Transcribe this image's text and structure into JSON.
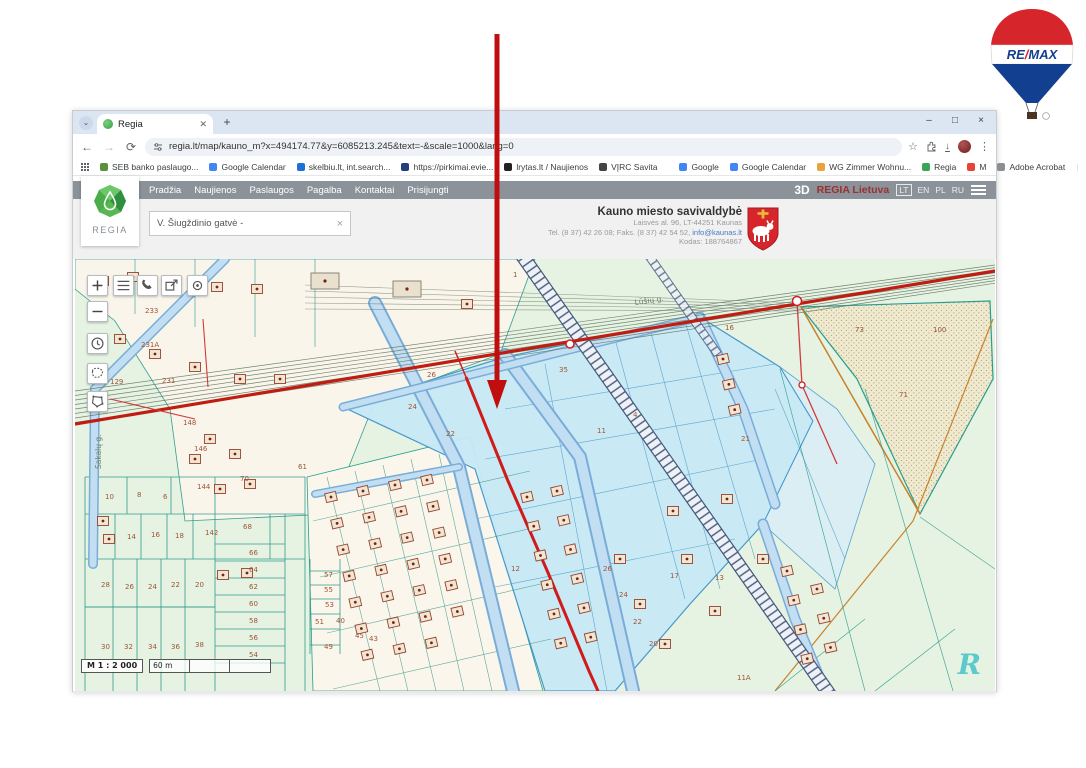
{
  "browser": {
    "tab_title": "Regia",
    "new_tab": "+",
    "window_controls": [
      "–",
      "□",
      "×"
    ],
    "url": "regia.lt/map/kauno_m?x=494174.77&y=6085213.245&text=-&scale=1000&lang=0",
    "bookmarks_left": [
      {
        "label": "SEB banko paslaugo...",
        "color": "#5a8f3c"
      },
      {
        "label": "Google Calendar",
        "color": "#4285f4"
      },
      {
        "label": "skelbiu.lt, int.search...",
        "color": "#1e6fd9"
      },
      {
        "label": "https://pirkimai.evie...",
        "color": "#24407c"
      },
      {
        "label": "lrytas.lt / Naujienos",
        "color": "#222222"
      },
      {
        "label": "VĮRC Savita",
        "color": "#444444"
      }
    ],
    "bookmarks_right": [
      {
        "label": "Google",
        "color": "#4285f4"
      },
      {
        "label": "Google Calendar",
        "color": "#4285f4"
      },
      {
        "label": "WG Zimmer Wohnu...",
        "color": "#e8a33d"
      },
      {
        "label": "Regia",
        "color": "#3aa655"
      },
      {
        "label": "M",
        "color": "#ea4335"
      },
      {
        "label": "Adobe Acrobat",
        "color": "#8a8f94"
      }
    ],
    "all_bookmarks": "Visos žymės"
  },
  "site": {
    "logo_text": "REGIA",
    "nav": [
      "Pradžia",
      "Naujienos",
      "Paslaugos",
      "Pagalba",
      "Kontaktai",
      "Prisijungti"
    ],
    "three_d": "3D",
    "brand": "REGIA Lietuva",
    "languages": [
      "LT",
      "EN",
      "PL",
      "RU"
    ],
    "search_value": "V. Šiugždinio gatvė -",
    "search_clear": "×",
    "municipality": {
      "name": "Kauno miesto savivaldybė",
      "address": "Laisvės al. 96, LT-44251 Kaunas",
      "contacts_prefix": "Tel. (8 37) 42 26 08; Faks. (8 37) 42 54 52, ",
      "email": "info@kaunas.lt",
      "code": "Kodas: 188764867"
    }
  },
  "map": {
    "controls": [
      "zoom-in",
      "legend",
      "identify",
      "share",
      "locate",
      "zoom-out",
      "history",
      "select-lasso",
      "select-polygon"
    ],
    "scale_label": "M 1 : 2 000",
    "scale_distance": "60 m",
    "watermark": "R",
    "street_labels": [
      {
        "text": "Lūšių g.",
        "x": 560,
        "y": 46,
        "rotate": -8
      },
      {
        "text": "Sakalų g.",
        "x": 26,
        "y": 210,
        "rotate": -90
      }
    ],
    "parcel_labels": [
      {
        "t": "233",
        "x": 70,
        "y": 54
      },
      {
        "t": "231A",
        "x": 66,
        "y": 88
      },
      {
        "t": "231",
        "x": 87,
        "y": 124
      },
      {
        "t": "129",
        "x": 35,
        "y": 125
      },
      {
        "t": "10",
        "x": 30,
        "y": 240
      },
      {
        "t": "8",
        "x": 62,
        "y": 238
      },
      {
        "t": "6",
        "x": 88,
        "y": 240
      },
      {
        "t": "14",
        "x": 52,
        "y": 280
      },
      {
        "t": "16",
        "x": 76,
        "y": 278
      },
      {
        "t": "18",
        "x": 100,
        "y": 279
      },
      {
        "t": "142",
        "x": 130,
        "y": 276
      },
      {
        "t": "68",
        "x": 168,
        "y": 270
      },
      {
        "t": "66",
        "x": 174,
        "y": 296
      },
      {
        "t": "64",
        "x": 174,
        "y": 313
      },
      {
        "t": "62",
        "x": 174,
        "y": 330
      },
      {
        "t": "60",
        "x": 174,
        "y": 347
      },
      {
        "t": "58",
        "x": 174,
        "y": 364
      },
      {
        "t": "56",
        "x": 174,
        "y": 381
      },
      {
        "t": "54",
        "x": 174,
        "y": 398
      },
      {
        "t": "28",
        "x": 26,
        "y": 328
      },
      {
        "t": "26",
        "x": 50,
        "y": 330
      },
      {
        "t": "24",
        "x": 73,
        "y": 330
      },
      {
        "t": "22",
        "x": 96,
        "y": 328
      },
      {
        "t": "20",
        "x": 120,
        "y": 328
      },
      {
        "t": "30",
        "x": 26,
        "y": 390
      },
      {
        "t": "32",
        "x": 49,
        "y": 390
      },
      {
        "t": "34",
        "x": 73,
        "y": 390
      },
      {
        "t": "36",
        "x": 96,
        "y": 390
      },
      {
        "t": "38",
        "x": 120,
        "y": 388
      },
      {
        "t": "57",
        "x": 249,
        "y": 318
      },
      {
        "t": "55",
        "x": 249,
        "y": 333
      },
      {
        "t": "53",
        "x": 250,
        "y": 348
      },
      {
        "t": "51",
        "x": 240,
        "y": 365
      },
      {
        "t": "49",
        "x": 249,
        "y": 390
      },
      {
        "t": "61",
        "x": 223,
        "y": 210
      },
      {
        "t": "70",
        "x": 165,
        "y": 222
      },
      {
        "t": "144",
        "x": 122,
        "y": 230
      },
      {
        "t": "146",
        "x": 119,
        "y": 192
      },
      {
        "t": "148",
        "x": 108,
        "y": 166
      },
      {
        "t": "26",
        "x": 352,
        "y": 118
      },
      {
        "t": "24",
        "x": 333,
        "y": 150
      },
      {
        "t": "22",
        "x": 371,
        "y": 177
      },
      {
        "t": "35",
        "x": 484,
        "y": 113
      },
      {
        "t": "11",
        "x": 522,
        "y": 174
      },
      {
        "t": "4",
        "x": 558,
        "y": 158
      },
      {
        "t": "1",
        "x": 438,
        "y": 18
      },
      {
        "t": "12",
        "x": 436,
        "y": 312
      },
      {
        "t": "26",
        "x": 528,
        "y": 312
      },
      {
        "t": "24",
        "x": 544,
        "y": 338
      },
      {
        "t": "22",
        "x": 558,
        "y": 365
      },
      {
        "t": "20",
        "x": 574,
        "y": 387
      },
      {
        "t": "17",
        "x": 595,
        "y": 319
      },
      {
        "t": "13",
        "x": 640,
        "y": 321
      },
      {
        "t": "11A",
        "x": 662,
        "y": 421
      },
      {
        "t": "16",
        "x": 650,
        "y": 71
      },
      {
        "t": "73",
        "x": 780,
        "y": 73
      },
      {
        "t": "100",
        "x": 858,
        "y": 73
      },
      {
        "t": "71",
        "x": 824,
        "y": 138
      },
      {
        "t": "21",
        "x": 666,
        "y": 182
      },
      {
        "t": "40",
        "x": 261,
        "y": 364
      },
      {
        "t": "45",
        "x": 280,
        "y": 379
      },
      {
        "t": "43",
        "x": 294,
        "y": 382
      }
    ]
  },
  "remax": {
    "text": "RE/MAX"
  }
}
